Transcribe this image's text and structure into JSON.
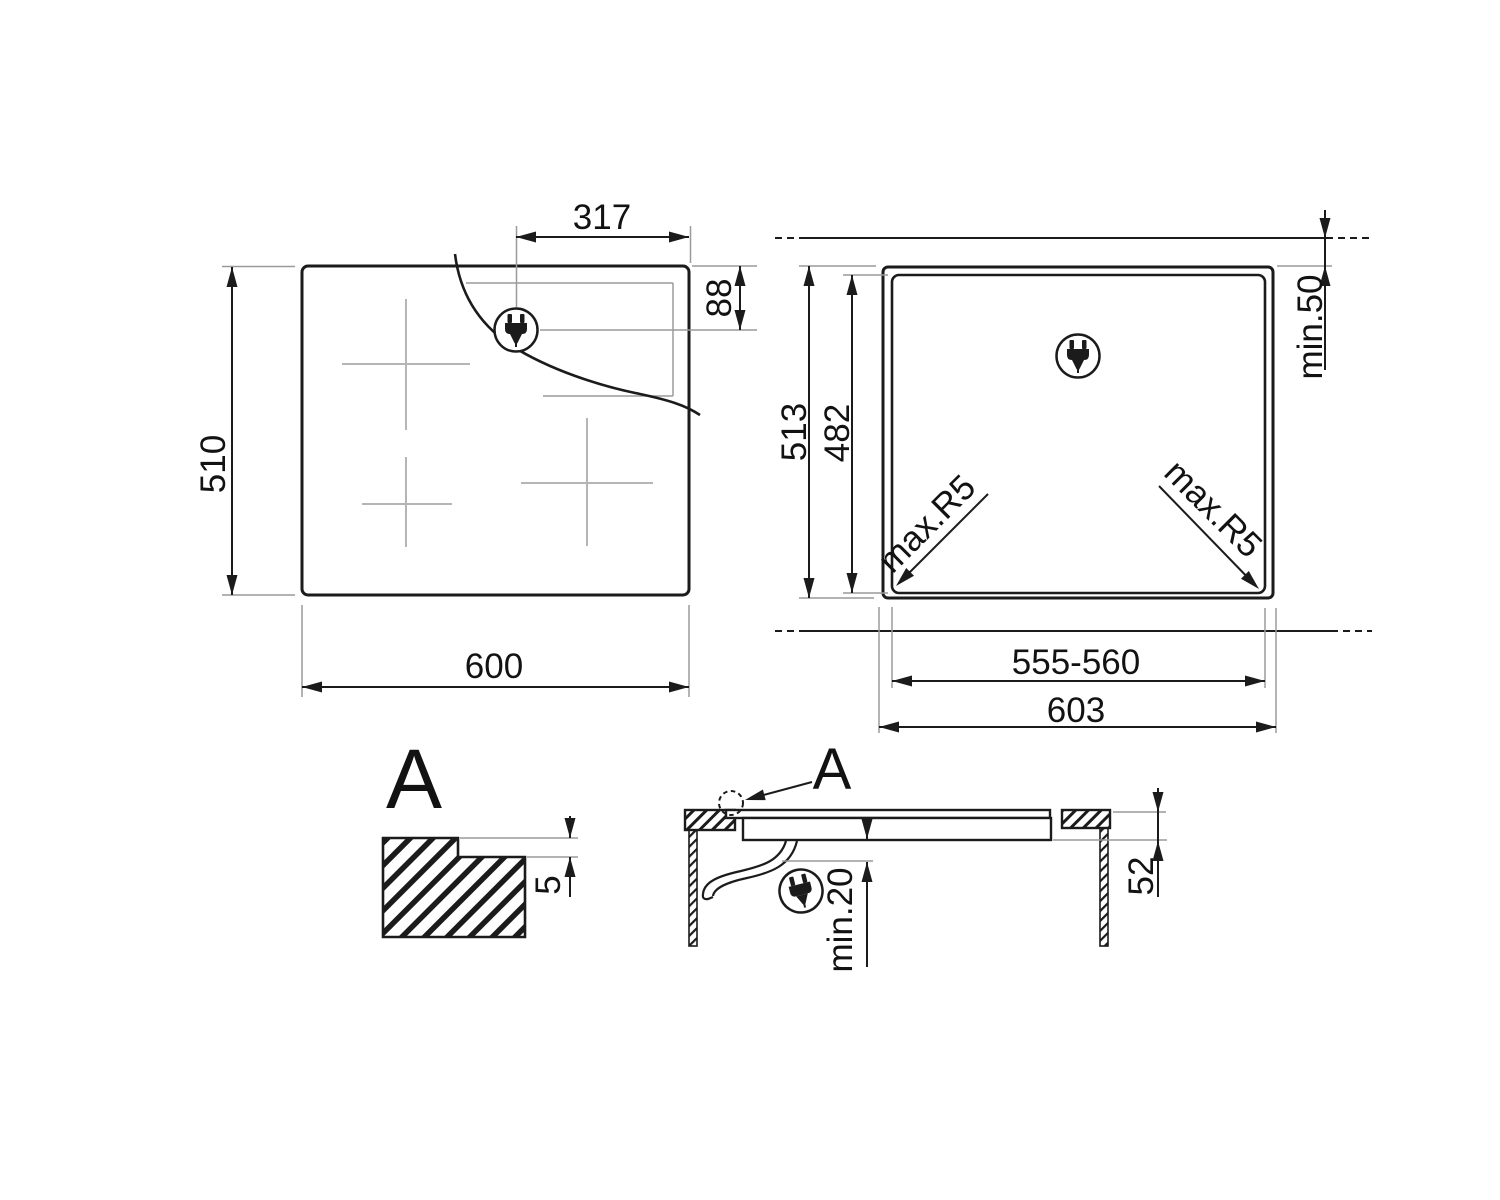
{
  "page": {
    "background": "#ffffff"
  },
  "colors": {
    "line": "#1b1b1b",
    "thin_line": "#9a9a9a",
    "zone_mark": "#b5b5b5"
  },
  "top_view": {
    "description": "hob top view",
    "width": "600",
    "height": "510",
    "plug_offset_x": "317",
    "plug_offset_y": "88",
    "plug_icon": "power-plug-icon"
  },
  "cutout_view": {
    "description": "worktop cutout plan",
    "outer_height": "513",
    "cutout_height": "482",
    "top_clearance": "min.50",
    "corner_radius_left": "max.R5",
    "corner_radius_right": "max.R5",
    "cutout_width": "555-560",
    "outer_width": "603",
    "plug_icon": "power-plug-icon"
  },
  "detail_a": {
    "label": "A",
    "rebate_depth": "5"
  },
  "section_view": {
    "label": "A",
    "clearance_below": "min.20",
    "built_in_depth": "52",
    "plug_icon": "power-plug-icon"
  }
}
